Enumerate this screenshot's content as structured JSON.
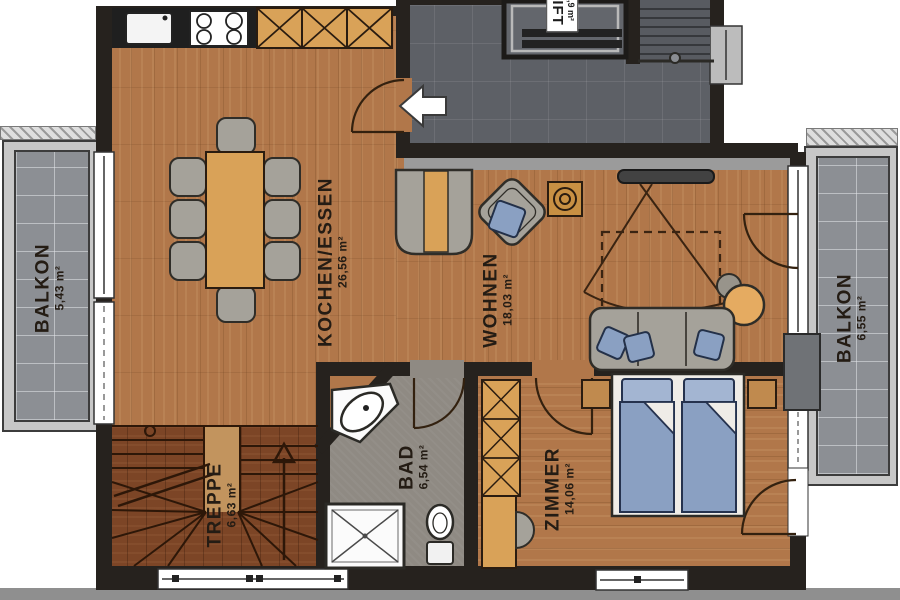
{
  "title": "floor-plan",
  "labels": {
    "balkon_left": {
      "name": "BALKON",
      "area": "5,43 m²"
    },
    "kochen_essen": {
      "name": "KOCHEN/ESSEN",
      "area": "26,56 m²"
    },
    "wohnen": {
      "name": "WOHNEN",
      "area": "18,03 m²"
    },
    "bad": {
      "name": "BAD",
      "area": "6,54 m²"
    },
    "zimmer": {
      "name": "ZIMMER",
      "area": "14,06 m²"
    },
    "treppe": {
      "name": "TREPPE",
      "area": "6,63 m²"
    },
    "balkon_right": {
      "name": "BALKON",
      "area": "6,55 m²"
    },
    "lift": {
      "name": "LIFT",
      "area": "2,9 m²"
    }
  },
  "colors": {
    "wood": "#b1774a",
    "stair_wood": "#7c4526",
    "corridor_tile": "#5d6066",
    "balcony_tile": "#8c8f94",
    "bad_floor": "#8f8a83",
    "wall": "#26221e",
    "cabinet_wood": "#d9a258",
    "fabric_blue": "#8aa0c2",
    "upholstery_gray": "#a5a29a",
    "fixture_white": "#ffffff",
    "lamp_orange": "#e5ab61"
  }
}
